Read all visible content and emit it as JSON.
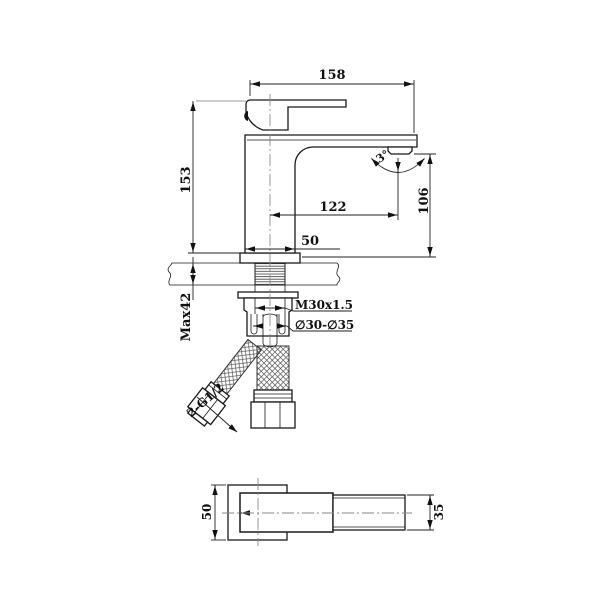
{
  "drawing": {
    "subject": "single-lever basin mixer faucet installation drawing",
    "front_view": {
      "dimensions": {
        "overall_length": "158",
        "height_deck_to_handle": "153",
        "spout_reach": "122",
        "outlet_height": "106",
        "body_width": "50",
        "max_deck_thickness": "Max42",
        "shank_thread": "M30x1.5",
        "mounting_hole": "∅30-∅35",
        "hose_thread": "2-G1/2",
        "swivel_angle": "3°"
      }
    },
    "bottom_view": {
      "dimensions": {
        "base_width": "50",
        "spout_width": "35"
      }
    }
  }
}
